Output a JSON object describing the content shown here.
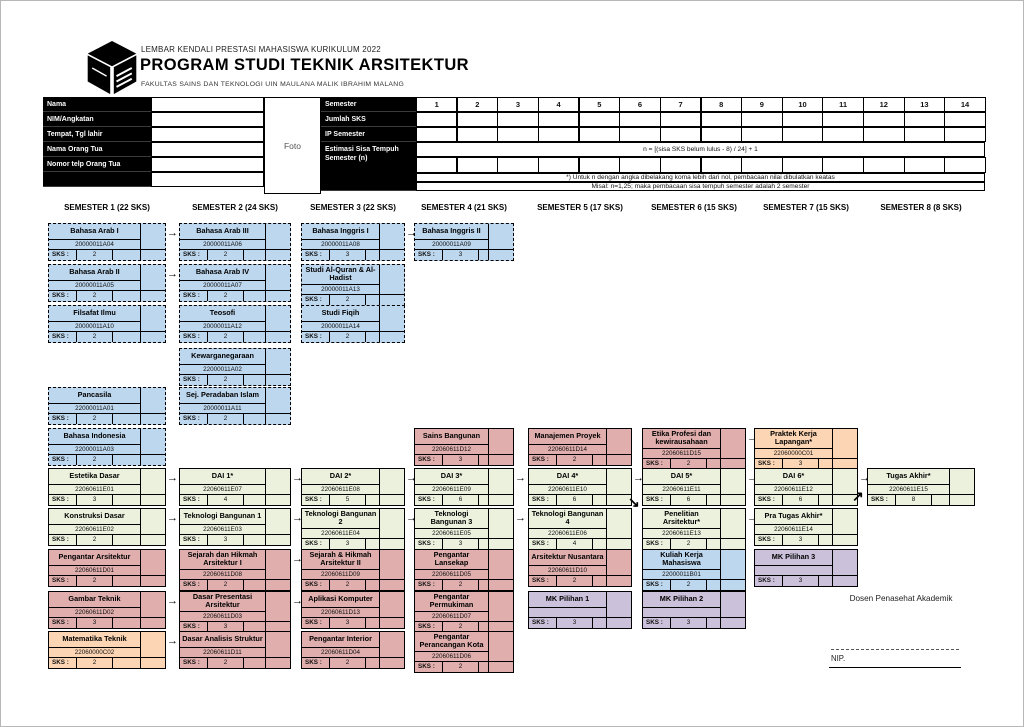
{
  "header": {
    "line1": "LEMBAR KENDALI PRESTASI MAHASISWA KURIKULUM 2022",
    "title": "PROGRAM STUDI TEKNIK ARSITEKTUR",
    "line3": "FAKULTAS SAINS DAN TEKNOLOGI UIN MAULANA MALIK IBRAHIM MALANG"
  },
  "form": {
    "rows": [
      "Nama",
      "NIM/Angkatan",
      "Tempat, Tgl lahir",
      "Nama Orang Tua",
      "Nomor telp Orang Tua"
    ],
    "photo": "Foto"
  },
  "summary": {
    "row_labels": [
      "Semester",
      "Jumlah SKS",
      "IP Semester",
      "Estimasi Sisa Tempuh Semester (n)"
    ],
    "semesters": [
      "1",
      "2",
      "3",
      "4",
      "5",
      "6",
      "7",
      "8",
      "9",
      "10",
      "11",
      "12",
      "13",
      "14"
    ],
    "formula": "n = [(sisa SKS belum lulus - 8) / 24] + 1",
    "notes": [
      "*) Untuk n dengan angka dibelakang koma lebih dari nol, pembacaan nilai dibulatkan keatas",
      "Misal: n=1,25; maka pembacaan sisa tempuh semester adalah 2 semester"
    ]
  },
  "semesters": [
    {
      "label": "SEMESTER 1 (22 SKS)"
    },
    {
      "label": "SEMESTER 2 (24 SKS)"
    },
    {
      "label": "SEMESTER 3 (22 SKS)"
    },
    {
      "label": "SEMESTER 4 (21 SKS)"
    },
    {
      "label": "SEMESTER 5 (17 SKS)"
    },
    {
      "label": "SEMESTER 6 (15 SKS)"
    },
    {
      "label": "SEMESTER 7 (15 SKS)"
    },
    {
      "label": "SEMESTER 8 (8 SKS)"
    }
  ],
  "sks_label": "SKS :",
  "colors": {
    "blue": "#bdd7ee",
    "green": "#ecf1de",
    "pink": "#dfaead",
    "orange": "#fcd5b4",
    "purple": "#ccc1da"
  },
  "cards": [
    {
      "title": "Bahasa Arab I",
      "code": "20000011A04",
      "sks": "2",
      "col": 1,
      "row": "A",
      "color": "blue",
      "dashed": true,
      "arrow": true
    },
    {
      "title": "Bahasa Arab II",
      "code": "20000011A05",
      "sks": "2",
      "col": 1,
      "row": "B",
      "color": "blue",
      "dashed": true,
      "arrow": true
    },
    {
      "title": "Filsafat Ilmu",
      "code": "20000011A10",
      "sks": "2",
      "col": 1,
      "row": "C",
      "color": "blue",
      "dashed": true,
      "arrow": false
    },
    {
      "title": "Pancasila",
      "code": "22000011A01",
      "sks": "2",
      "col": 1,
      "row": "E",
      "color": "blue",
      "dashed": true,
      "arrow": false
    },
    {
      "title": "Bahasa Indonesia",
      "code": "22000011A03",
      "sks": "2",
      "col": 1,
      "row": "F",
      "color": "blue",
      "dashed": true,
      "arrow": false
    },
    {
      "title": "Estetika Dasar",
      "code": "22060611E01",
      "sks": "3",
      "col": 1,
      "row": "G",
      "color": "green",
      "dashed": false,
      "arrow": true
    },
    {
      "title": "Konstruksi Dasar",
      "code": "22060611E02",
      "sks": "2",
      "col": 1,
      "row": "H",
      "color": "green",
      "dashed": false,
      "arrow": true
    },
    {
      "title": "Pengantar Arsitektur",
      "code": "22060611D01",
      "sks": "2",
      "col": 1,
      "row": "I",
      "color": "pink",
      "dashed": false,
      "arrow": false
    },
    {
      "title": "Gambar Teknik",
      "code": "22060611D02",
      "sks": "3",
      "col": 1,
      "row": "J",
      "color": "pink",
      "dashed": false,
      "arrow": true
    },
    {
      "title": "Matematika Teknik",
      "code": "22060000C02",
      "sks": "2",
      "col": 1,
      "row": "K",
      "color": "orange",
      "dashed": false,
      "arrow": true
    },
    {
      "title": "Bahasa Arab III",
      "code": "20000011A06",
      "sks": "2",
      "col": 2,
      "row": "A",
      "color": "blue",
      "dashed": true,
      "arrow": false
    },
    {
      "title": "Bahasa Arab IV",
      "code": "20000011A07",
      "sks": "2",
      "col": 2,
      "row": "B",
      "color": "blue",
      "dashed": true,
      "arrow": false
    },
    {
      "title": "Teosofi",
      "code": "20000011A12",
      "sks": "2",
      "col": 2,
      "row": "C",
      "color": "blue",
      "dashed": true,
      "arrow": false
    },
    {
      "title": "Kewarganegaraan",
      "code": "22000011A02",
      "sks": "2",
      "col": 2,
      "row": "D",
      "color": "blue",
      "dashed": true,
      "arrow": false
    },
    {
      "title": "Sej. Peradaban Islam",
      "code": "20000011A11",
      "sks": "2",
      "col": 2,
      "row": "E",
      "color": "blue",
      "dashed": true,
      "arrow": false
    },
    {
      "title": "DAI 1*",
      "code": "22060611E07",
      "sks": "4",
      "col": 2,
      "row": "G",
      "color": "green",
      "dashed": false,
      "arrow": true
    },
    {
      "title": "Teknologi Bangunan 1",
      "code": "22060611E03",
      "sks": "3",
      "col": 2,
      "row": "H",
      "color": "green",
      "dashed": false,
      "arrow": true
    },
    {
      "title": "Sejarah dan Hikmah Arsitektur I",
      "code": "22060611D08",
      "sks": "2",
      "col": 2,
      "row": "I",
      "color": "pink",
      "dashed": false,
      "arrow": true
    },
    {
      "title": "Dasar Presentasi Arsitektur",
      "code": "22060611D03",
      "sks": "3",
      "col": 2,
      "row": "J",
      "color": "pink",
      "dashed": false,
      "arrow": true
    },
    {
      "title": "Dasar Analisis Struktur",
      "code": "22060611D11",
      "sks": "2",
      "col": 2,
      "row": "K",
      "color": "pink",
      "dashed": false,
      "arrow": false
    },
    {
      "title": "Bahasa Inggris I",
      "code": "20000011A08",
      "sks": "3",
      "col": 3,
      "row": "A",
      "color": "blue",
      "dashed": true,
      "arrow": true
    },
    {
      "title": "Studi Al-Quran & Al-Hadist",
      "code": "20000011A13",
      "sks": "2",
      "col": 3,
      "row": "B",
      "color": "blue",
      "dashed": true,
      "arrow": false
    },
    {
      "title": "Studi Fiqih",
      "code": "20000011A14",
      "sks": "2",
      "col": 3,
      "row": "C",
      "color": "blue",
      "dashed": true,
      "arrow": false
    },
    {
      "title": "DAI 2*",
      "code": "22060611E08",
      "sks": "5",
      "col": 3,
      "row": "G",
      "color": "green",
      "dashed": false,
      "arrow": true
    },
    {
      "title": "Teknologi Bangunan 2",
      "code": "22060611E04",
      "sks": "3",
      "col": 3,
      "row": "H",
      "color": "green",
      "dashed": false,
      "arrow": true
    },
    {
      "title": "Sejarah & Hikmah Arsitektur II",
      "code": "22060611D09",
      "sks": "2",
      "col": 3,
      "row": "I",
      "color": "pink",
      "dashed": false,
      "arrow": false
    },
    {
      "title": "Aplikasi Komputer",
      "code": "22060611D13",
      "sks": "3",
      "col": 3,
      "row": "J",
      "color": "pink",
      "dashed": false,
      "arrow": false
    },
    {
      "title": "Pengantar Interior",
      "code": "22060611D04",
      "sks": "2",
      "col": 3,
      "row": "K",
      "color": "pink",
      "dashed": false,
      "arrow": false
    },
    {
      "title": "Bahasa Inggris II",
      "code": "20000011A09",
      "sks": "3",
      "col": 4,
      "row": "A",
      "color": "blue",
      "dashed": true,
      "arrow": false
    },
    {
      "title": "Sains Bangunan",
      "code": "22060611D12",
      "sks": "3",
      "col": 4,
      "row": "F",
      "color": "pink",
      "dashed": false,
      "arrow": false
    },
    {
      "title": "DAI 3*",
      "code": "22060611E09",
      "sks": "6",
      "col": 4,
      "row": "G",
      "color": "green",
      "dashed": false,
      "arrow": true
    },
    {
      "title": "Teknologi Bangunan 3",
      "code": "22060611E05",
      "sks": "3",
      "col": 4,
      "row": "H",
      "color": "green",
      "dashed": false,
      "arrow": true
    },
    {
      "title": "Pengantar Lansekap",
      "code": "22060611D05",
      "sks": "2",
      "col": 4,
      "row": "I",
      "color": "pink",
      "dashed": false,
      "arrow": false
    },
    {
      "title": "Pengantar Permukiman",
      "code": "22060611D07",
      "sks": "2",
      "col": 4,
      "row": "J",
      "color": "pink",
      "dashed": false,
      "arrow": false
    },
    {
      "title": "Pengantar Perancangan Kota",
      "code": "22060611D06",
      "sks": "2",
      "col": 4,
      "row": "K",
      "color": "pink",
      "dashed": false,
      "arrow": false
    },
    {
      "title": "Manajemen Proyek",
      "code": "22060611D14",
      "sks": "2",
      "col": 5,
      "row": "F",
      "color": "pink",
      "dashed": false,
      "arrow": false
    },
    {
      "title": "DAI 4*",
      "code": "22060611E10",
      "sks": "6",
      "col": 5,
      "row": "G",
      "color": "green",
      "dashed": false,
      "arrow": true
    },
    {
      "title": "Teknologi Bangunan 4",
      "code": "22060611E06",
      "sks": "4",
      "col": 5,
      "row": "H",
      "color": "green",
      "dashed": false,
      "arrow": false
    },
    {
      "title": "Arsitektur Nusantara",
      "code": "22060611D10",
      "sks": "2",
      "col": 5,
      "row": "I",
      "color": "pink",
      "dashed": false,
      "arrow": false
    },
    {
      "title": "MK Pilihan 1",
      "code": "",
      "sks": "3",
      "col": 5,
      "row": "J",
      "color": "purple",
      "dashed": false,
      "arrow": false
    },
    {
      "title": "Etika Profesi dan kewirausahaan",
      "code": "22060611D15",
      "sks": "2",
      "col": 6,
      "row": "F",
      "color": "pink",
      "dashed": false,
      "arrow": true
    },
    {
      "title": "DAI 5*",
      "code": "22060611E11",
      "sks": "6",
      "col": 6,
      "row": "G",
      "color": "green",
      "dashed": false,
      "arrow": true
    },
    {
      "title": "Penelitian Arsitektur*",
      "code": "22060611E13",
      "sks": "2",
      "col": 6,
      "row": "H",
      "color": "green",
      "dashed": false,
      "arrow": true
    },
    {
      "title": "Kuliah Kerja Mahasiswa",
      "code": "22000011B01",
      "sks": "2",
      "col": 6,
      "row": "I",
      "color": "blue",
      "dashed": false,
      "arrow": false
    },
    {
      "title": "MK Pilihan 2",
      "code": "",
      "sks": "3",
      "col": 6,
      "row": "J",
      "color": "purple",
      "dashed": false,
      "arrow": false
    },
    {
      "title": "Praktek Kerja Lapangan*",
      "code": "22060000C01",
      "sks": "3",
      "col": 7,
      "row": "F",
      "color": "orange",
      "dashed": false,
      "arrow": false
    },
    {
      "title": "DAI 6*",
      "code": "22060611E12",
      "sks": "6",
      "col": 7,
      "row": "G",
      "color": "green",
      "dashed": false,
      "arrow": true
    },
    {
      "title": "Pra Tugas Akhir*",
      "code": "22060611E14",
      "sks": "3",
      "col": 7,
      "row": "H",
      "color": "green",
      "dashed": false,
      "arrow": false
    },
    {
      "title": "MK Pilihan 3",
      "code": "",
      "sks": "3",
      "col": 7,
      "row": "I",
      "color": "purple",
      "dashed": false,
      "arrow": false
    },
    {
      "title": "Tugas Akhir*",
      "code": "22060611E15",
      "sks": "8",
      "col": 8,
      "row": "G",
      "color": "green",
      "dashed": false,
      "arrow": false
    }
  ],
  "extra_arrows": [
    {
      "glyph": "↘",
      "x": 627,
      "y": 494
    },
    {
      "glyph": "↗",
      "x": 851,
      "y": 488
    }
  ],
  "footer": {
    "advisor": "Dosen Penasehat Akademik",
    "nip_label": "NIP."
  }
}
